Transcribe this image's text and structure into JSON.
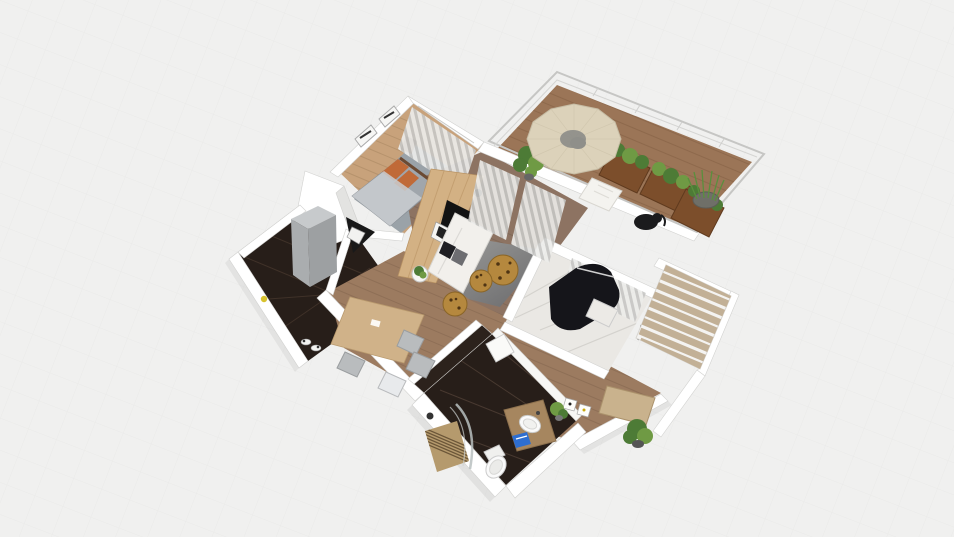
{
  "app": {
    "name": "3d-floorplan-viewport",
    "view": "top-down perspective render",
    "visible_text": ""
  },
  "canvas": {
    "width": 954,
    "height": 537
  },
  "palette": {
    "background": "#f0f0ef",
    "grid": "#e7e7e5",
    "wall": "#ffffff",
    "wall_shade": "#e3e3e1",
    "wall_edge": "#d2d2d0",
    "glass": "#c6c6c4",
    "deck_wood": "#9b7557",
    "bedroom_wood": "#c8a27b",
    "bedroom_rug": "#9aa2a8",
    "living_wood": "#8d7362",
    "hall_wood": "#9c7b60",
    "dark_marble": "#271e19",
    "dark_wall": "#2c221c",
    "white_marble": "#eae8e4",
    "accent_wood": "#d3b184",
    "tv_black": "#121212",
    "sofa": "#f2f0ec",
    "pillow_dark": "#1f1f23",
    "pillow_gray": "#6d6d71",
    "leopard": "#b5883e",
    "leopard_spot": "#4f3413",
    "parasol": "#dcd2ba",
    "parasol_center": "#8f8f8a",
    "planter": "#7c4e2b",
    "plant": "#4d7b36",
    "plant_light": "#6f9a44",
    "grass_pot": "#6f6f68",
    "statue": "#1b1b1d",
    "fridge_top": "#c7cacc",
    "fridge_side": "#9da0a2",
    "fridge_front": "#aaadaf",
    "counter_dark": "#191919",
    "bed": "#a0a6ac",
    "pillow_orange": "#c06a38",
    "table_wood": "#d0b289",
    "chair_gray": "#b9bcbe",
    "chair_light": "#e8eaec",
    "shelf_beige": "#c2b096",
    "piano": "#15151a",
    "vanity": "#a6865f",
    "porcelain": "#fafafa",
    "towel_blue": "#2e6ed0",
    "slat": "#b59a6d",
    "desk": "#c9b28d",
    "yellow_item": "#d8c22e"
  },
  "rooms": [
    {
      "id": "bedroom",
      "label": "bedroom",
      "floor": "light wood + gray rug",
      "furniture": [
        "bed",
        "orange-pillows",
        "wall-art",
        "nightstand",
        "window-curtain"
      ]
    },
    {
      "id": "balcony",
      "label": "balcony",
      "floor": "wood deck, glazed",
      "furniture": [
        "parasol",
        "lounge-chair",
        "planter-box",
        "grass-pot",
        "elephant-statue",
        "potted-plant"
      ]
    },
    {
      "id": "living-room",
      "label": "living room",
      "floor": "wood + gray rug",
      "furniture": [
        "tv-accent-wall",
        "tv",
        "sofa",
        "side-table",
        "leopard-pouf",
        "sheer-curtains",
        "floor-lamp"
      ]
    },
    {
      "id": "kitchen",
      "label": "kitchen",
      "floor": "dark marble",
      "furniture": [
        "refrigerator",
        "corner-sink",
        "dishes"
      ]
    },
    {
      "id": "dining",
      "label": "dining area",
      "floor": "wood",
      "furniture": [
        "dining-table",
        "dining-chair"
      ]
    },
    {
      "id": "piano-room",
      "label": "piano room",
      "floor": "white marble",
      "furniture": [
        "grand-piano",
        "piano-bench",
        "stool",
        "sheer-curtains"
      ]
    },
    {
      "id": "hallway",
      "label": "hallway",
      "floor": "wood",
      "furniture": [
        "desk",
        "shelving-unit",
        "small-frames",
        "potted-plant"
      ]
    },
    {
      "id": "bathroom",
      "label": "bathroom",
      "floor": "dark marble",
      "furniture": [
        "vanity",
        "basin-sink",
        "blue-towel",
        "toilet",
        "shower-mat",
        "glass-screen",
        "mirror-cabinet",
        "plant"
      ]
    }
  ]
}
